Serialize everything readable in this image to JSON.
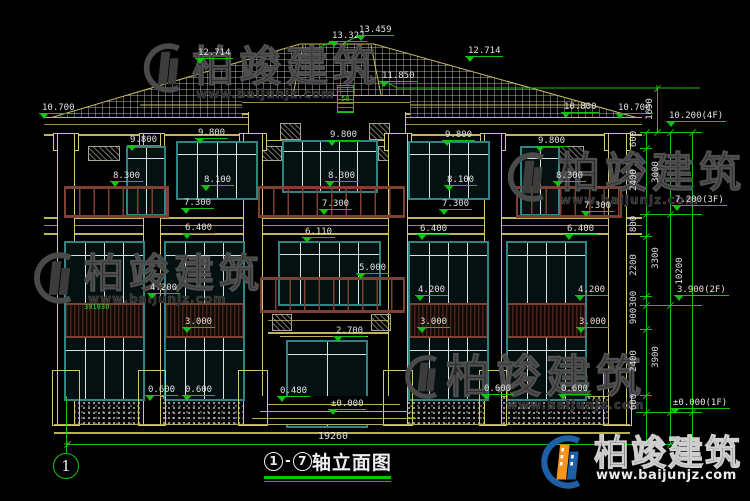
{
  "drawing": {
    "title_axis_start": "1",
    "title_axis_end": "7",
    "title_suffix": "轴立面图",
    "axis_bubble": "1",
    "overall_width_dim": "19260"
  },
  "watermark": {
    "brand": "柏竣建筑",
    "url": "www.baijunjz.com"
  },
  "notes": {
    "roof_vent": "50",
    "window_note": "301030"
  },
  "elevation_markers": [
    {
      "t": "13.322",
      "x": 329,
      "y": 31
    },
    {
      "t": "13.459",
      "x": 356,
      "y": 25
    },
    {
      "t": "12.714",
      "x": 195,
      "y": 48
    },
    {
      "t": "12.714",
      "x": 465,
      "y": 46
    },
    {
      "t": "11.850",
      "x": 379,
      "y": 71
    },
    {
      "t": "10.700",
      "x": 39,
      "y": 103
    },
    {
      "t": "10.800",
      "x": 561,
      "y": 102
    },
    {
      "t": "10.700",
      "x": 615,
      "y": 103
    },
    {
      "t": "9.800",
      "x": 127,
      "y": 135
    },
    {
      "t": "9.800",
      "x": 195,
      "y": 128
    },
    {
      "t": "9.800",
      "x": 327,
      "y": 130
    },
    {
      "t": "9.800",
      "x": 442,
      "y": 130
    },
    {
      "t": "9.800",
      "x": 535,
      "y": 136
    },
    {
      "t": "8.300",
      "x": 110,
      "y": 171
    },
    {
      "t": "8.100",
      "x": 201,
      "y": 175
    },
    {
      "t": "8.300",
      "x": 325,
      "y": 171
    },
    {
      "t": "8.100",
      "x": 444,
      "y": 175
    },
    {
      "t": "8.300",
      "x": 553,
      "y": 171
    },
    {
      "t": "7.300",
      "x": 181,
      "y": 198
    },
    {
      "t": "7.300",
      "x": 319,
      "y": 199
    },
    {
      "t": "7.300",
      "x": 439,
      "y": 199
    },
    {
      "t": "7.300",
      "x": 581,
      "y": 201
    },
    {
      "t": "6.400",
      "x": 182,
      "y": 223
    },
    {
      "t": "6.400",
      "x": 417,
      "y": 224
    },
    {
      "t": "6.400",
      "x": 564,
      "y": 224
    },
    {
      "t": "6.110",
      "x": 302,
      "y": 227
    },
    {
      "t": "5.000",
      "x": 356,
      "y": 263
    },
    {
      "t": "4.200",
      "x": 147,
      "y": 283
    },
    {
      "t": "4.200",
      "x": 415,
      "y": 285
    },
    {
      "t": "4.200",
      "x": 575,
      "y": 285
    },
    {
      "t": "3.000",
      "x": 182,
      "y": 317
    },
    {
      "t": "3.000",
      "x": 417,
      "y": 317
    },
    {
      "t": "3.000",
      "x": 576,
      "y": 317
    },
    {
      "t": "2.700",
      "x": 333,
      "y": 326
    },
    {
      "t": "0.600",
      "x": 145,
      "y": 385
    },
    {
      "t": "0.600",
      "x": 182,
      "y": 385
    },
    {
      "t": "0.480",
      "x": 277,
      "y": 386
    },
    {
      "t": "±0.000",
      "x": 328,
      "y": 399
    },
    {
      "t": "0.600",
      "x": 481,
      "y": 384
    },
    {
      "t": "0.600",
      "x": 558,
      "y": 384
    }
  ],
  "right_flags": [
    {
      "t": "10.200(4F)",
      "x": 666,
      "y": 111
    },
    {
      "t": "7.200(3F)",
      "x": 672,
      "y": 195
    },
    {
      "t": "3.900(2F)",
      "x": 674,
      "y": 285
    },
    {
      "t": "±0.000(1F)",
      "x": 670,
      "y": 398
    }
  ],
  "vertical_dims": [
    {
      "t": "600",
      "x": 634,
      "y": 140
    },
    {
      "t": "2400",
      "x": 634,
      "y": 181
    },
    {
      "t": "800",
      "x": 634,
      "y": 225
    },
    {
      "t": "2200",
      "x": 634,
      "y": 266
    },
    {
      "t": "300",
      "x": 634,
      "y": 300
    },
    {
      "t": "900",
      "x": 634,
      "y": 317
    },
    {
      "t": "2400",
      "x": 634,
      "y": 362
    },
    {
      "t": "600",
      "x": 634,
      "y": 403
    },
    {
      "t": "3000",
      "x": 656,
      "y": 173
    },
    {
      "t": "3300",
      "x": 656,
      "y": 259
    },
    {
      "t": "3900",
      "x": 656,
      "y": 358
    },
    {
      "t": "10200",
      "x": 680,
      "y": 272
    },
    {
      "t": "1650",
      "x": 650,
      "y": 110
    }
  ],
  "colors": {
    "background": "#000000",
    "cad_yellow": "#c0b65e",
    "dimension_green": "#15c115",
    "window_teal": "#2f8583",
    "railing_brown": "#7c4130",
    "text_white": "#e2e2e2",
    "logo_orange": "#f7941d",
    "logo_blue": "#1e5fa8"
  }
}
